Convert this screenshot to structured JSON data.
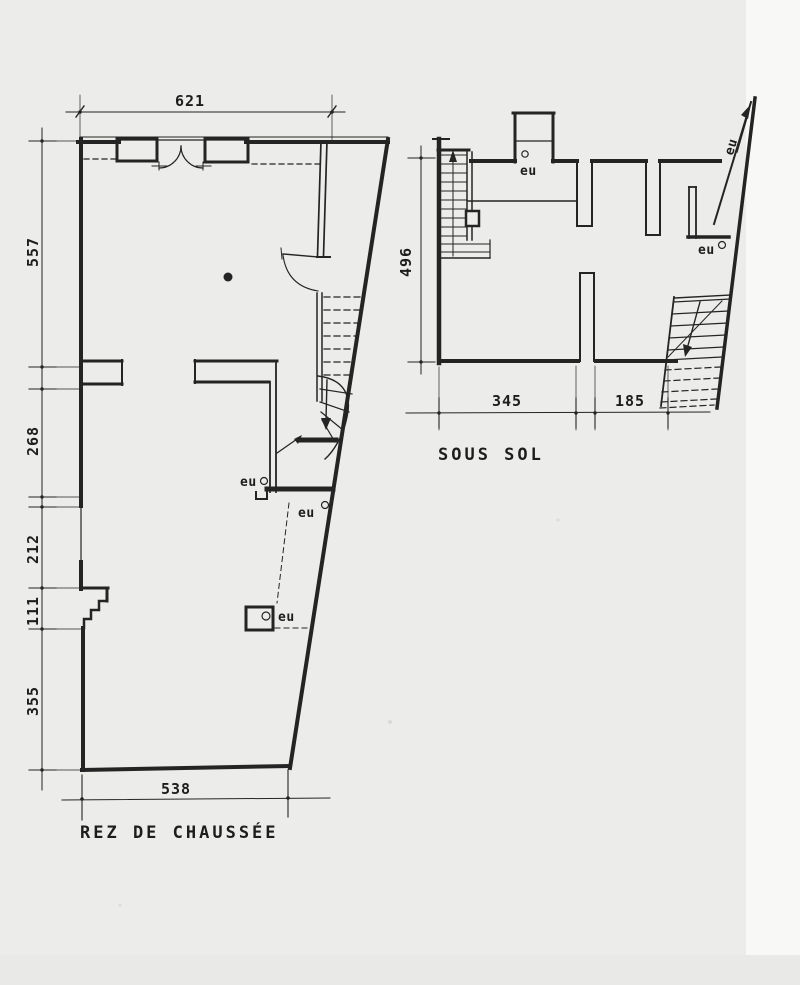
{
  "drawing": {
    "type": "architectural floor plans, scanned pencil/ink drawing",
    "paper_color": "#ececea",
    "ink_color": "#1d1d1d"
  },
  "ground_floor": {
    "title": "REZ DE CHAUSSÉE",
    "dim_top": "621",
    "dim_bottom": "538",
    "dim_left": [
      "557",
      "268",
      "212",
      "111",
      "355"
    ],
    "eu_labels": [
      "eu",
      "eu",
      "eu"
    ]
  },
  "basement": {
    "title": "SOUS SOL",
    "dim_left": "496",
    "dim_bottom": [
      "345",
      "185"
    ],
    "eu_labels": [
      "eu",
      "eu",
      "eu"
    ]
  }
}
